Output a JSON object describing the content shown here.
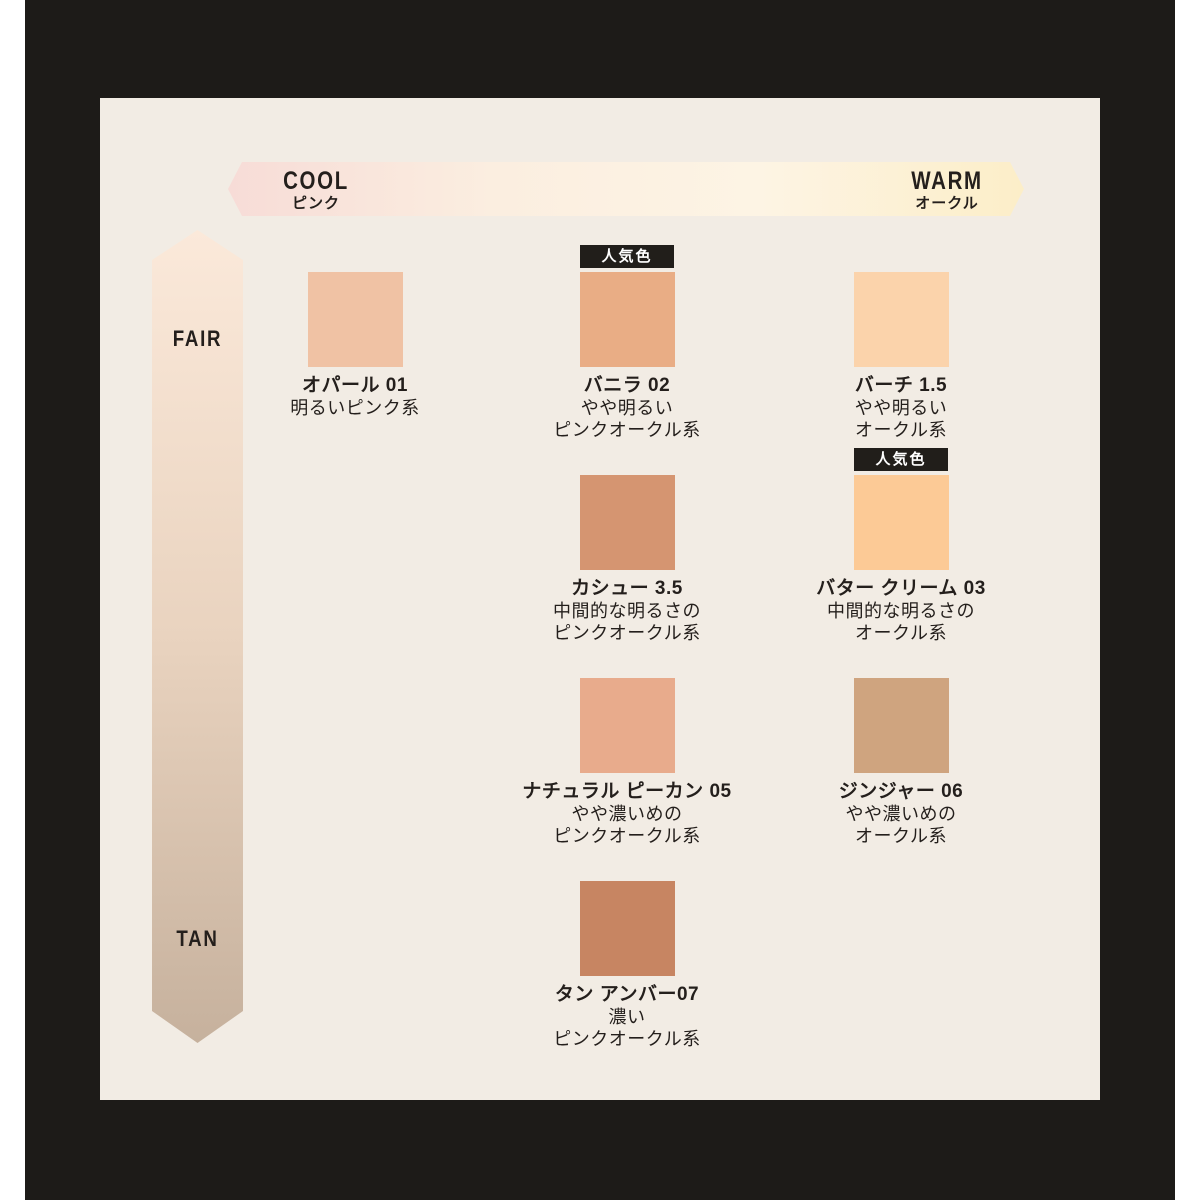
{
  "colors": {
    "page_bg": "#ffffff",
    "frame": "#1d1b18",
    "panel": "#f2ece4",
    "text": "#241f1c",
    "badge_bg": "#211e1a",
    "badge_text": "#ffffff"
  },
  "axes": {
    "horizontal": {
      "left_label": "COOL",
      "left_sublabel": "ピンク",
      "right_label": "WARM",
      "right_sublabel": "オークル",
      "gradient": [
        "#f7dcd7",
        "#fbeee0",
        "#fdf4e4",
        "#fceec8"
      ]
    },
    "vertical": {
      "top_label": "FAIR",
      "bottom_label": "TAN",
      "gradient": [
        "#fbe9da",
        "#e9d3bf",
        "#c6b19d"
      ]
    }
  },
  "badge": {
    "label": "人気色"
  },
  "shades": [
    {
      "name": "オパール 01",
      "color": "#f0c2a4",
      "popular": false,
      "desc": [
        "明るいピンク系"
      ]
    },
    {
      "name": "バニラ 02",
      "color": "#e9ad85",
      "popular": true,
      "desc": [
        "やや明るい",
        "ピンクオークル系"
      ]
    },
    {
      "name": "バーチ 1.5",
      "color": "#fbd3ab",
      "popular": false,
      "desc": [
        "やや明るい",
        "オークル系"
      ]
    },
    {
      "name": "カシュー 3.5",
      "color": "#d59571",
      "popular": false,
      "desc": [
        "中間的な明るさの",
        "ピンクオークル系"
      ]
    },
    {
      "name": "バター クリーム 03",
      "color": "#fcca96",
      "popular": true,
      "desc": [
        "中間的な明るさの",
        "オークル系"
      ]
    },
    {
      "name": "ナチュラル ピーカン 05",
      "color": "#e8ab8c",
      "popular": false,
      "desc": [
        "やや濃いめの",
        "ピンクオークル系"
      ]
    },
    {
      "name": "ジンジャー 06",
      "color": "#cfa47f",
      "popular": false,
      "desc": [
        "やや濃いめの",
        "オークル系"
      ]
    },
    {
      "name": "タン アンバー07",
      "color": "#c78562",
      "popular": false,
      "desc": [
        "濃い",
        "ピンクオークル系"
      ]
    }
  ]
}
